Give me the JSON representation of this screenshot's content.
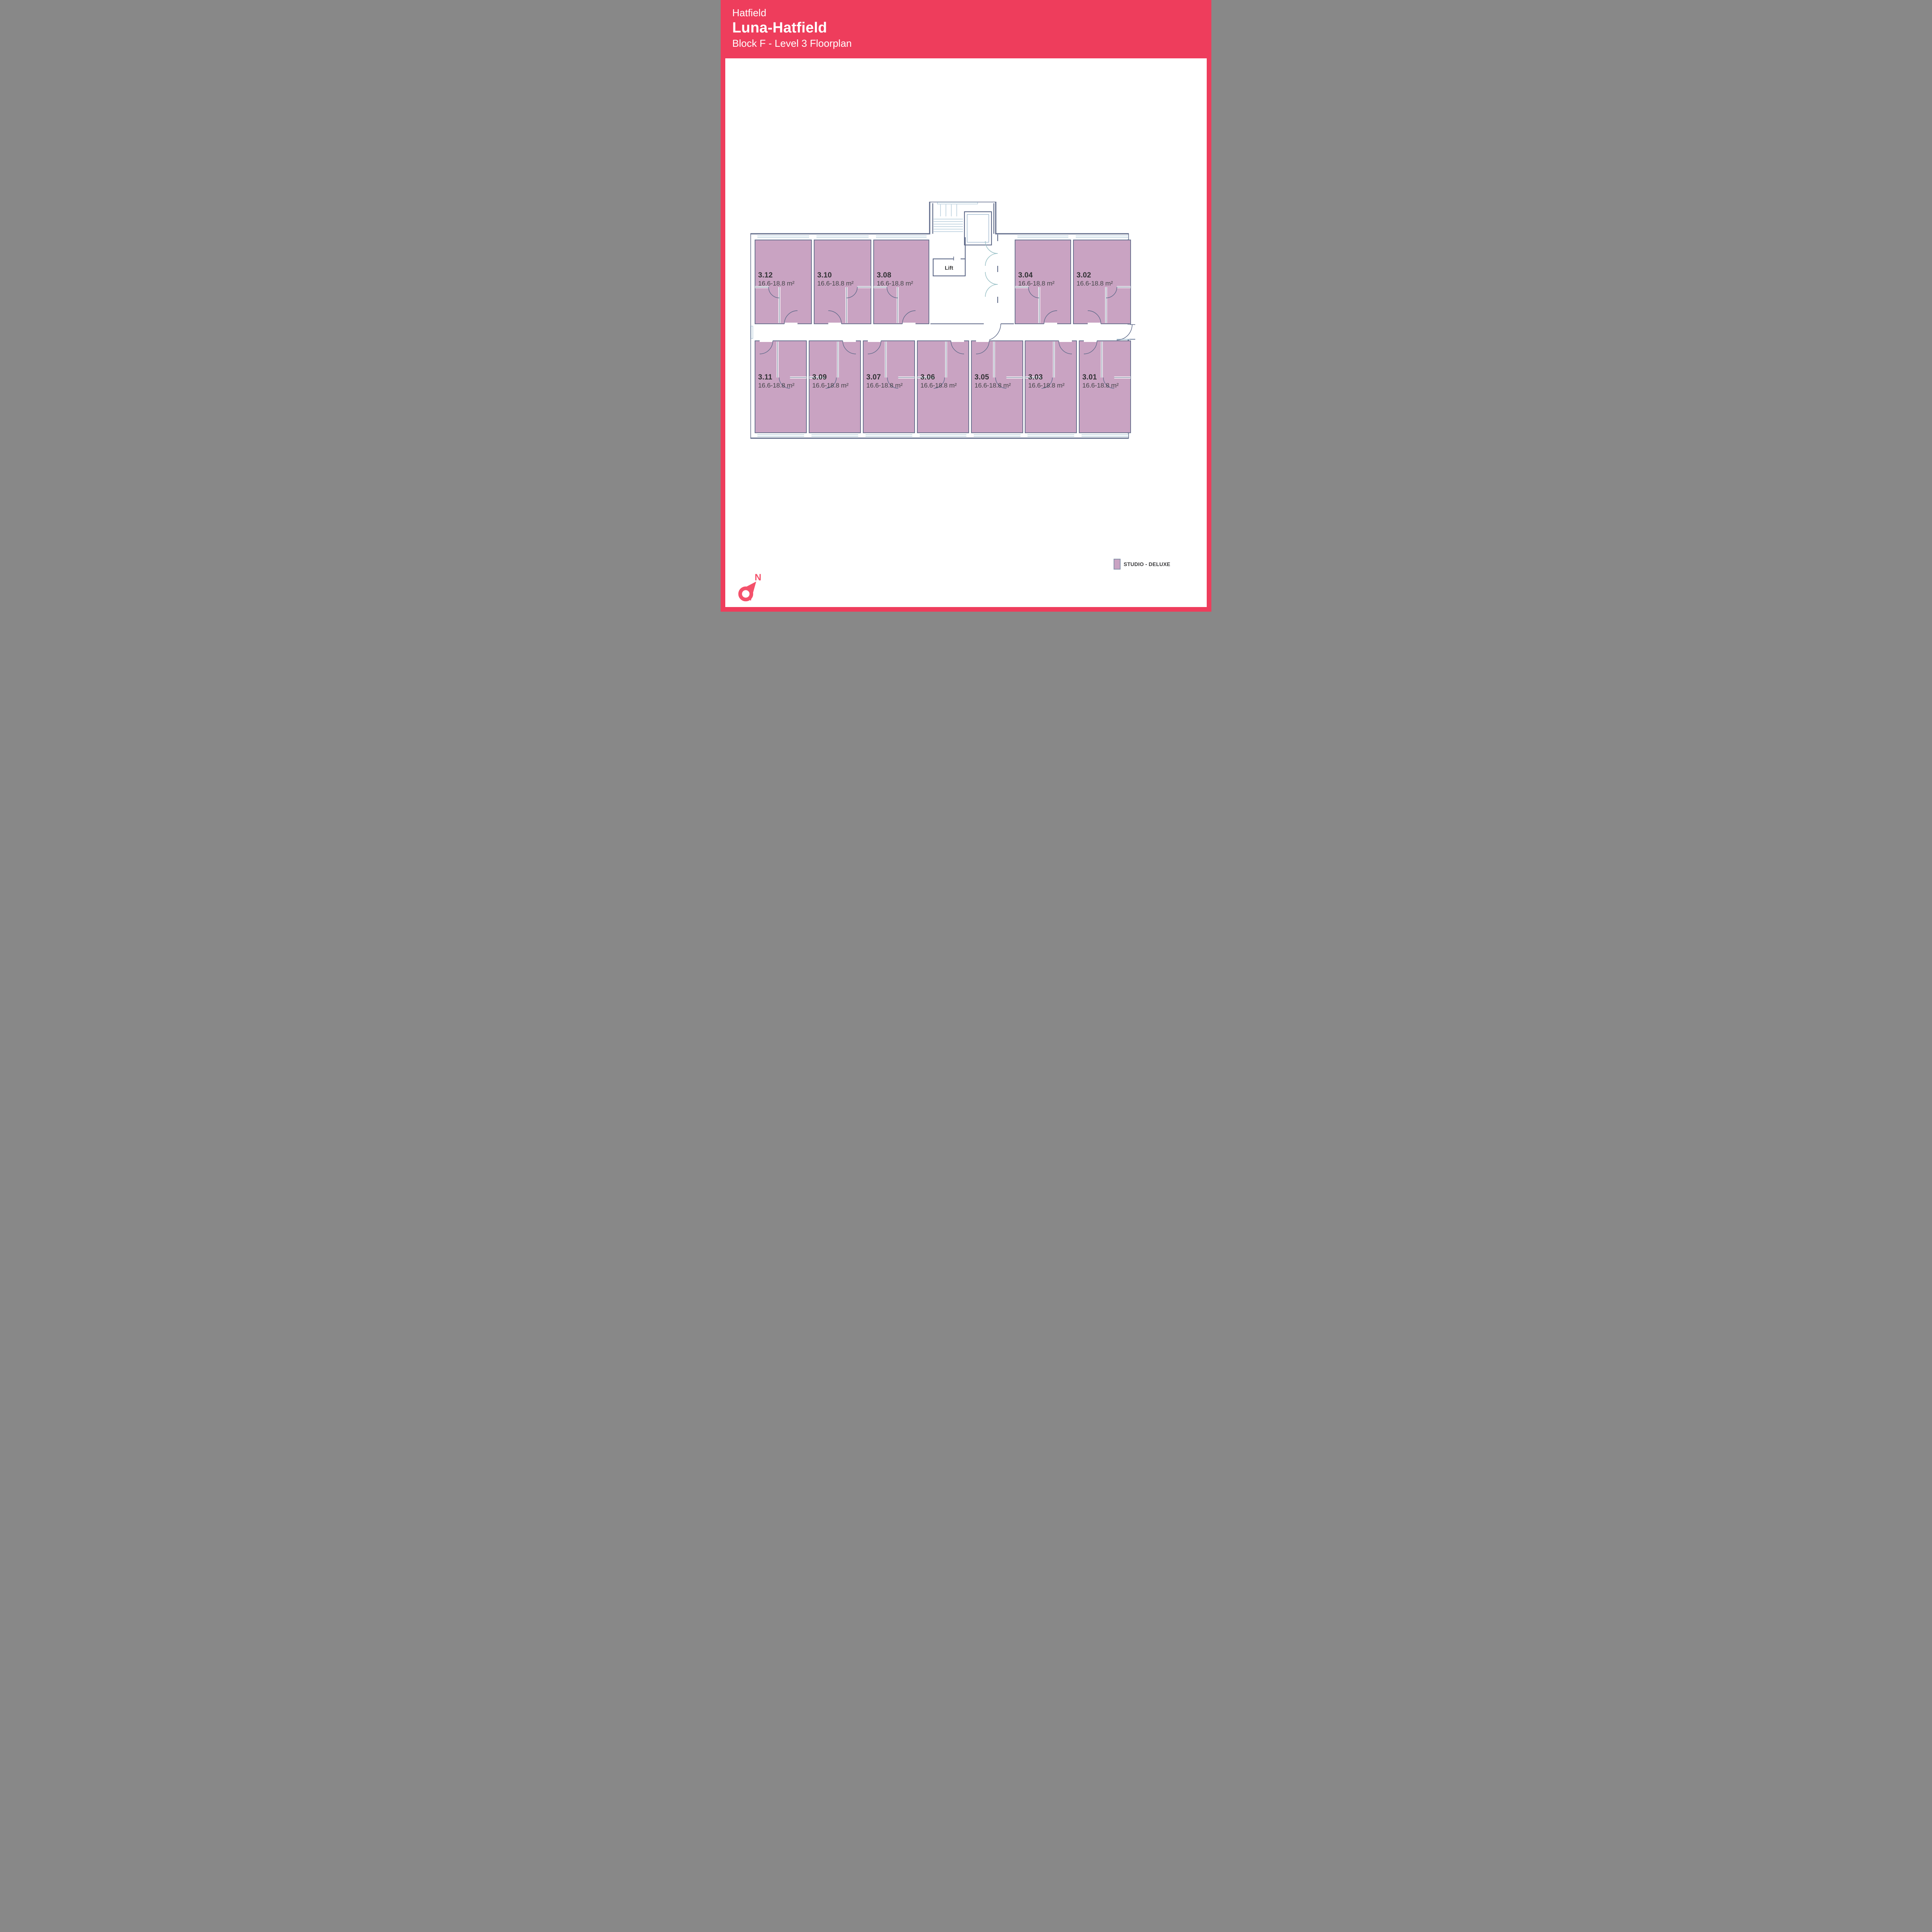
{
  "header": {
    "location": "Hatfield",
    "title": "Luna-Hatfield",
    "subtitle": "Block F - Level 3 Floorplan"
  },
  "floorplan": {
    "lift_label": "Lift",
    "rooms": [
      {
        "number": "3.12",
        "area": "16.6-18.8 m²"
      },
      {
        "number": "3.10",
        "area": "16.6-18.8 m²"
      },
      {
        "number": "3.08",
        "area": "16.6-18.8 m²"
      },
      {
        "number": "3.04",
        "area": "16.6-18.8 m²"
      },
      {
        "number": "3.02",
        "area": "16.6-18.8 m²"
      },
      {
        "number": "3.11",
        "area": "16.6-18.8 m²"
      },
      {
        "number": "3.09",
        "area": "16.6-18.8 m²"
      },
      {
        "number": "3.07",
        "area": "16.6-18.8 m²"
      },
      {
        "number": "3.06",
        "area": "16.6-18.8 m²"
      },
      {
        "number": "3.05",
        "area": "16.6-18.8 m²"
      },
      {
        "number": "3.03",
        "area": "16.6-18.8 m²"
      },
      {
        "number": "3.01",
        "area": "16.6-18.8 m²"
      }
    ]
  },
  "legend": {
    "items": [
      {
        "label": "STUDIO - DELUXE",
        "color": "#C9A3C2"
      }
    ]
  },
  "compass": {
    "label": "N"
  },
  "colors": {
    "accent": "#EE3D5C",
    "compass_red": "#F4516B",
    "room_fill": "#C9A3C2",
    "wall": "#5F6A89",
    "window_blue": "#A3C0D2",
    "door_light": "#9CC2C8",
    "text_dark": "#3A3A3C"
  }
}
